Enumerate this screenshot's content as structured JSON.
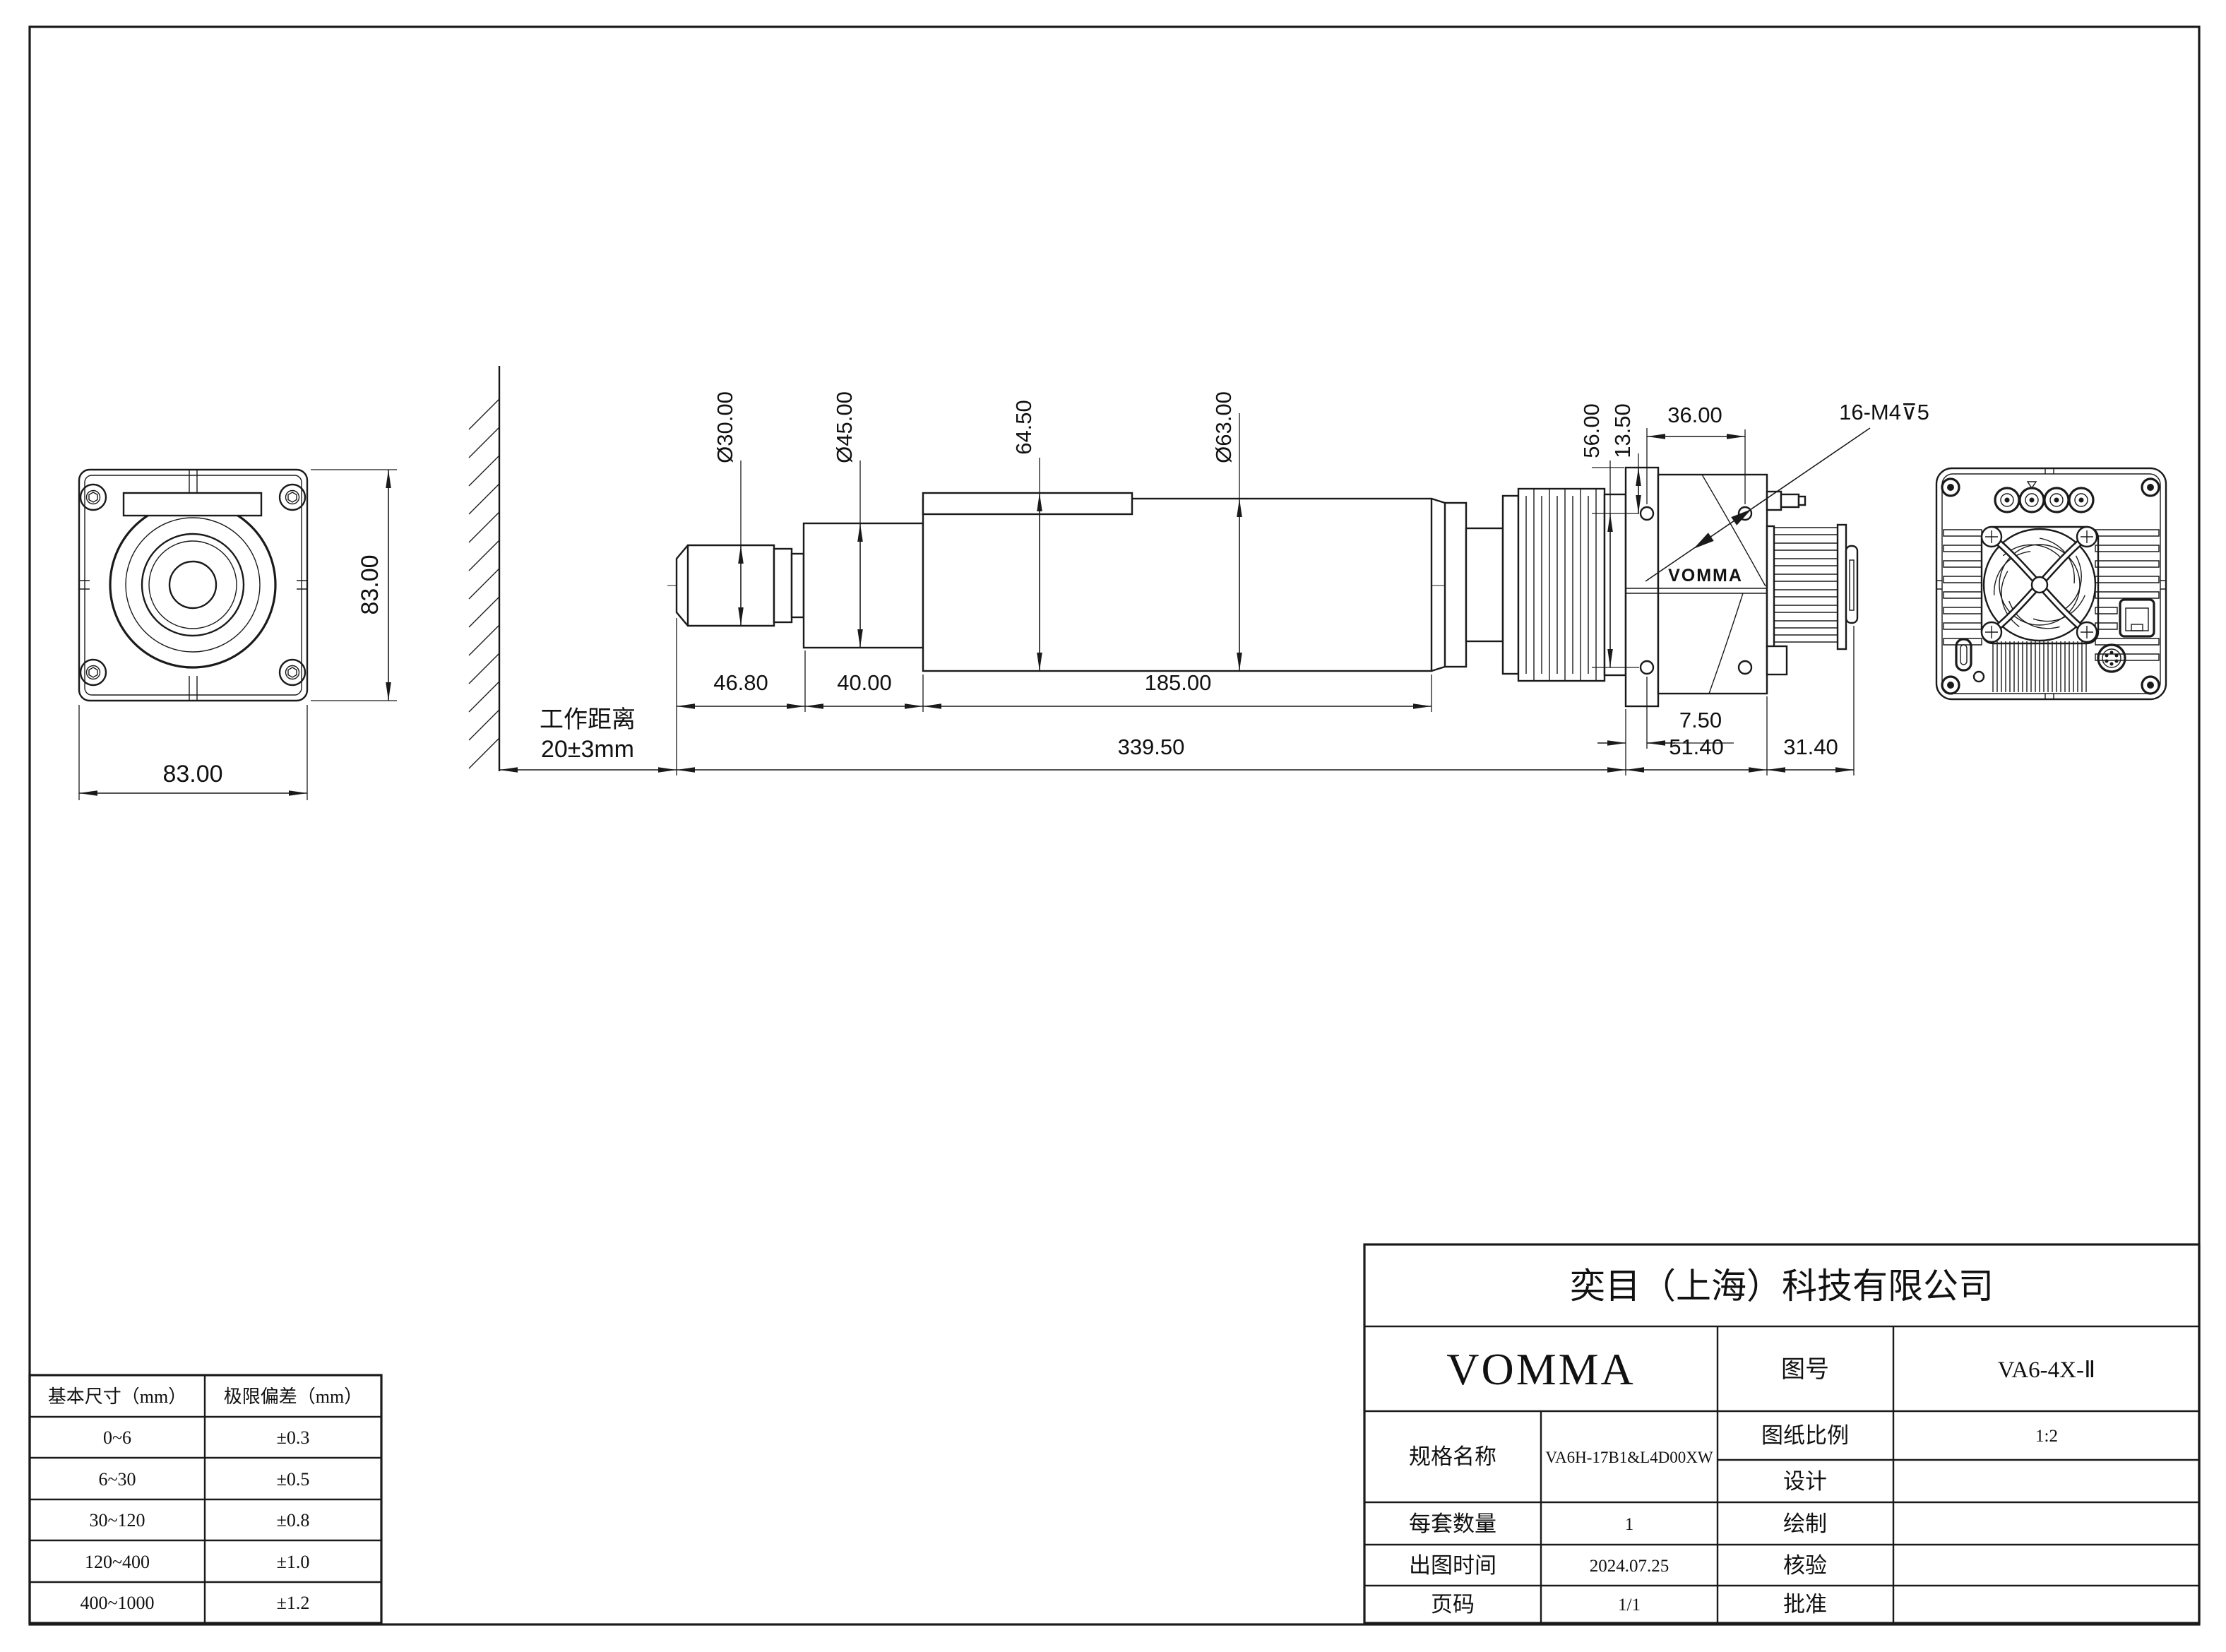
{
  "drawing": {
    "front_view": {
      "width": "83.00",
      "height": "83.00"
    },
    "side_view": {
      "working_distance_label": "工作距离",
      "working_distance_value": "20±3mm",
      "dia_lens": "Ø30.00",
      "dia_mid": "Ø45.00",
      "flange_height": "64.50",
      "dia_barrel": "Ø63.00",
      "cam_height": "56.00",
      "cam_hole_offset": "13.50",
      "cam_hole_span": "36.00",
      "thread_callout": "16-M4⊽5",
      "len_nose": "46.80",
      "len_mid": "40.00",
      "len_barrel": "185.00",
      "len_total": "339.50",
      "cam_face_offset": "7.50",
      "cam_length": "51.40",
      "cam_rear": "31.40",
      "logo": "VOMMA"
    },
    "tolerance_table": {
      "headers": [
        "基本尺寸（mm）",
        "极限偏差（mm）"
      ],
      "rows": [
        [
          "0~6",
          "±0.3"
        ],
        [
          "6~30",
          "±0.5"
        ],
        [
          "30~120",
          "±0.8"
        ],
        [
          "120~400",
          "±1.0"
        ],
        [
          "400~1000",
          "±1.2"
        ]
      ]
    },
    "title_block": {
      "company": "奕目（上海）科技有限公司",
      "brand": "VOMMA",
      "drawing_no_label": "图号",
      "drawing_no": "VA6-4X-Ⅱ",
      "spec_label": "规格名称",
      "spec": "VA6H-17B1&L4D00XW",
      "scale_label": "图纸比例",
      "scale": "1:2",
      "design_label": "设计",
      "design": "",
      "qty_label": "每套数量",
      "qty": "1",
      "draft_label": "绘制",
      "draft": "",
      "date_label": "出图时间",
      "date": "2024.07.25",
      "check_label": "核验",
      "check": "",
      "page_label": "页码",
      "page": "1/1",
      "approve_label": "批准",
      "approve": ""
    }
  }
}
